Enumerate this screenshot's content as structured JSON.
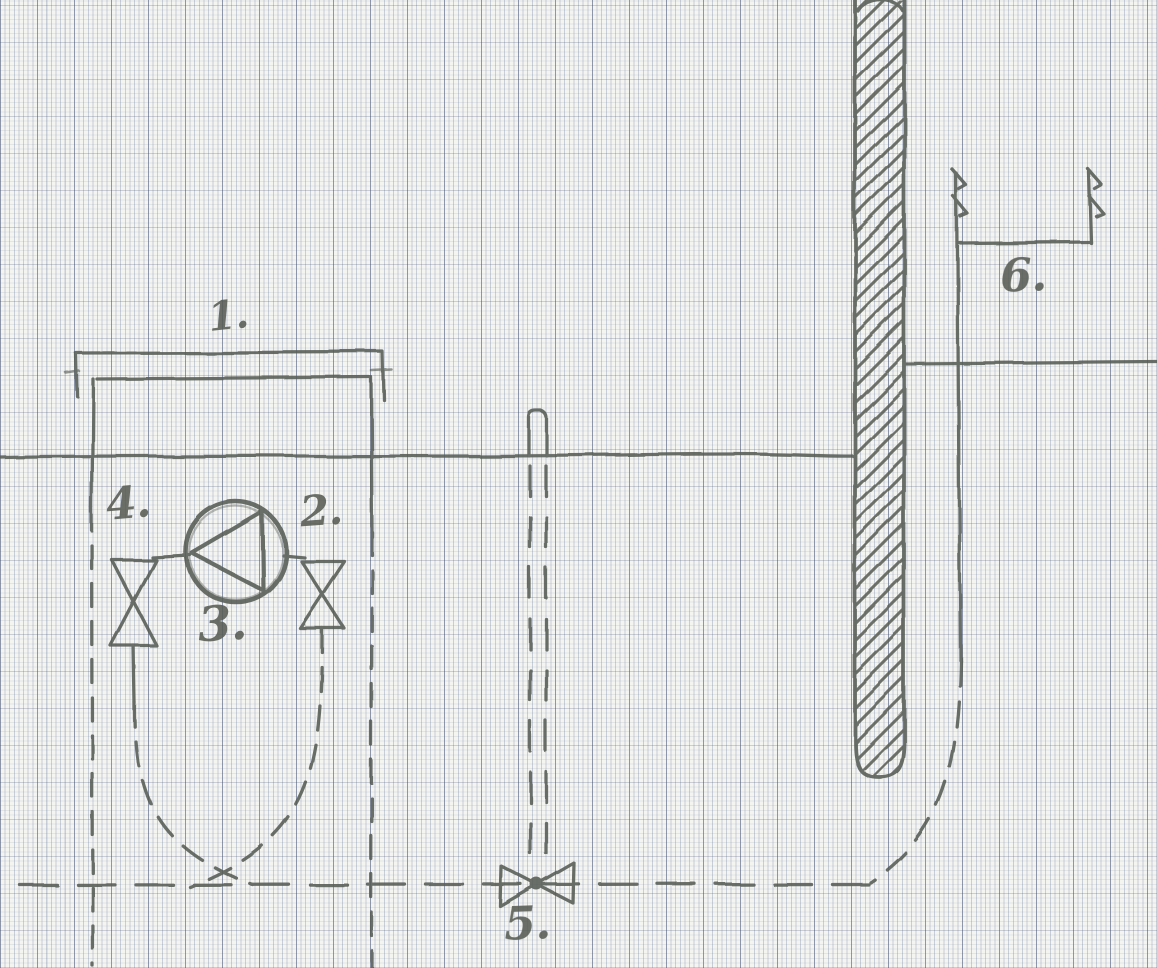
{
  "diagram": {
    "callouts": {
      "c1": "1.",
      "c2": "2.",
      "c3": "3.",
      "c4": "4.",
      "c5": "5.",
      "c6": "6."
    },
    "components": [
      {
        "name": "tank-top-cap",
        "callout": "1."
      },
      {
        "name": "right-gate-valve",
        "callout": "2."
      },
      {
        "name": "pump",
        "callout": "3."
      },
      {
        "name": "left-gate-valve",
        "callout": "4."
      },
      {
        "name": "foot-valve",
        "callout": "5."
      },
      {
        "name": "outlet-flow-arrows",
        "callout": "6."
      }
    ],
    "colors": {
      "paper": "#f4f4f1",
      "pencil": "#575c54",
      "grid_major": "#3a4c74",
      "grid_fine": "#64769b"
    }
  }
}
